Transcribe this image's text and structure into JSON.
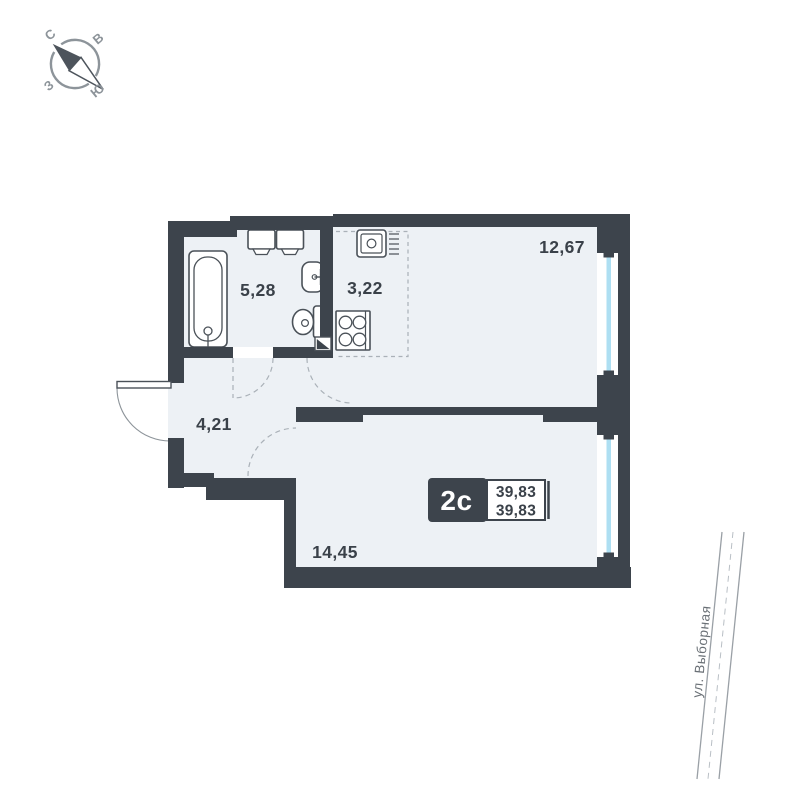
{
  "unit_badge": {
    "type": "2с",
    "area_total": "39,83",
    "area_living": "39,83"
  },
  "rooms": [
    {
      "name": "bathroom",
      "area": "5,28"
    },
    {
      "name": "kitchen-niche",
      "area": "3,22"
    },
    {
      "name": "kitchen-living-room",
      "area": "12,67"
    },
    {
      "name": "hallway",
      "area": "4,21"
    },
    {
      "name": "bedroom",
      "area": "14,45"
    }
  ],
  "compass": {
    "north": "С",
    "east": "В",
    "south": "Ю",
    "west": "З"
  },
  "street": {
    "label": "ул. Выборная"
  },
  "colors": {
    "wall": "#3d444c",
    "floor": "#edf1f5",
    "glass": "#aedff2",
    "fixture_line": "#4a5158",
    "muted": "#8d949a",
    "dash": "#aab1b8",
    "text": "#3a4149",
    "street_line": "#9aa0a6"
  }
}
